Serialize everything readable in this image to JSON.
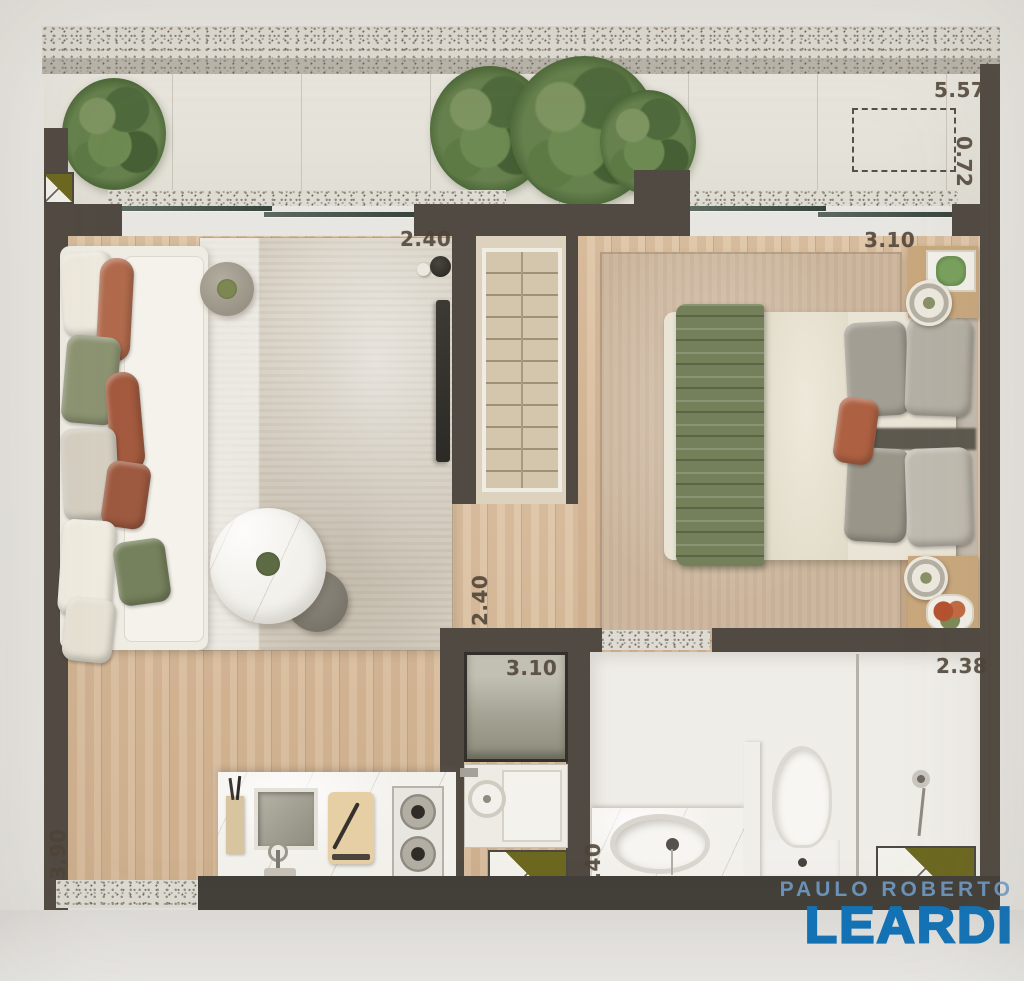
{
  "floor_plan": {
    "type": "apartment-top-view-rendered",
    "dimensions": {
      "balcony_width": "5.57",
      "balcony_depth": "0.72",
      "living_room_width": "2.40",
      "bedroom_width": "3.10",
      "hall_length": "2.40",
      "laundry_width": "3.10",
      "kitchen_length": "3.90",
      "vanity_length": "1.40",
      "bathroom_width": "2.38"
    },
    "colors": {
      "wall": "#514a42",
      "wood_floor": "#d7bda0",
      "balcony_floor": "#e6e3da",
      "living_rug": "#d6cfc2",
      "bedroom_rug": "#cdb79f",
      "dimension_text": "#4e4337"
    }
  },
  "watermark": {
    "line1": "PAULO ROBERTO",
    "line2": "LEARDI",
    "color_light": "#709bc7",
    "color_dark": "#1173b8"
  }
}
